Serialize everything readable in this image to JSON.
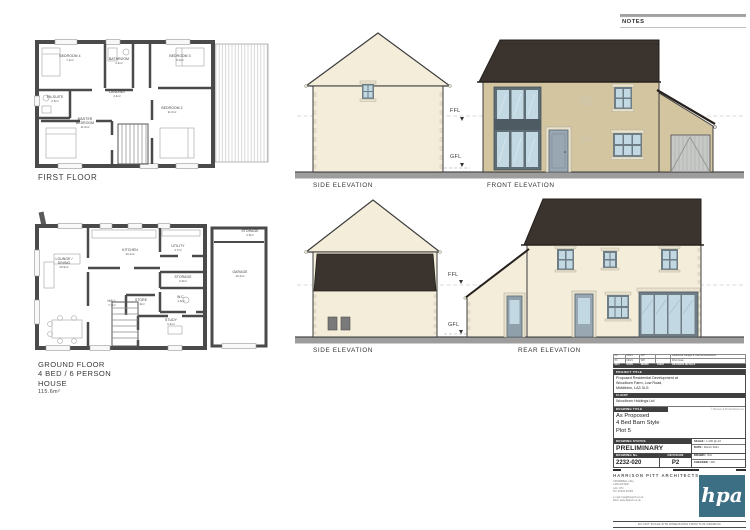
{
  "notes_panel": {
    "title": "NOTES"
  },
  "floor_plans": {
    "first_floor": {
      "title": "FIRST FLOOR",
      "rooms": [
        {
          "name": "BEDROOM 4",
          "area": "7.1m²"
        },
        {
          "name": "BATHROOM",
          "area": "4.4m²"
        },
        {
          "name": "BEDROOM 3",
          "area": "9.0m²"
        },
        {
          "name": "EN-SUITE",
          "area": "2.6m²"
        },
        {
          "name": "LANDING",
          "area": "4.4m²"
        },
        {
          "name": "MASTER BEDROOM",
          "area": "11.9m²"
        },
        {
          "name": "BEDROOM 2",
          "area": "11.0m²"
        }
      ]
    },
    "ground_floor": {
      "title": "GROUND FLOOR",
      "subtitle1": "4 BED / 6 PERSON",
      "subtitle2": "HOUSE",
      "area": "115.6m²",
      "rooms": [
        {
          "name": "LOUNGE / DINING",
          "area": "20.9m²"
        },
        {
          "name": "KITCHEN",
          "area": "10.4m²"
        },
        {
          "name": "UTILITY",
          "area": "4.7m²"
        },
        {
          "name": "STORAGE",
          "area": "0.9m²"
        },
        {
          "name": "HALL",
          "area": "7.4m²"
        },
        {
          "name": "STORE",
          "area": "1.9m²"
        },
        {
          "name": "W.C.",
          "area": "1.5m²"
        },
        {
          "name": "STUDY",
          "area": "6.4m²"
        },
        {
          "name": "GARAGE",
          "area": "16.4m²"
        },
        {
          "name": "STORAGE",
          "area": "2.8m²"
        }
      ]
    }
  },
  "elevations": {
    "top_side_label": "SIDE ELEVATION",
    "front_label": "FRONT ELEVATION",
    "mid_side_label": "SIDE ELEVATION",
    "rear_label": "REAR ELEVATION",
    "ffl": "FFL",
    "gfl": "GFL"
  },
  "title_block": {
    "revision_table": {
      "headers": [
        "REV",
        "DATE",
        "DRWN",
        "CHKD",
        "REVISION DETAILS"
      ],
      "rows": [
        {
          "rev": "P2",
          "date": "03/21",
          "drwn": "WH",
          "chkd": "-",
          "details": "Additional Garage & Internal Alterations"
        },
        {
          "rev": "P1",
          "date": "02/21",
          "drwn": "WH",
          "chkd": "-",
          "details": "First Issue"
        }
      ]
    },
    "project_title_label": "PROJECT TITLE",
    "project_title_lines": [
      "Proposed Residential Development at",
      "Woodburn Farm, Low Road,",
      "Middleton, LA3 3LG"
    ],
    "client_label": "CLIENT",
    "client": "Woodburn Holdings Ltd",
    "drawing_title_label": "DRAWING TITLE",
    "copyright": "© Harrison & Pitt Architects Ltd",
    "drawing_title_lines": [
      "As Proposed",
      "4 Bed Barn Style",
      "Plot 5"
    ],
    "drawing_status_label": "DRAWING STATUS",
    "drawing_status": "PRELIMINARY",
    "scale_label": "SCALE :",
    "scale": "1:100 @ A3",
    "date_label": "DATE :",
    "date": "March 2021",
    "drawing_no_label": "DRAWING No.",
    "drawing_no": "2232-020",
    "revision_label": "REVISION",
    "revision": "P2",
    "drawn_label": "DRAWN :",
    "drawn": "WH",
    "checked_label": "CHECKED :",
    "checked": "SW",
    "practice_name": "HARRISON PITT ARCHITECTS",
    "address_lines": [
      "CROMWELL HILL",
      "LANCASTER",
      "LA1 1YN",
      "Tel: 01524 63784"
    ],
    "email": "e-mail: hpa@hparch.co.uk",
    "web": "Web: www.hparch.co.uk",
    "logo_text": "hpa",
    "disclaimer": "DO NOT SCALE SITE DIMENSIONS FROM THIS DRAWING"
  },
  "colors": {
    "cream_wall": "#f4edda",
    "tan_wall": "#d2c5a0",
    "roof_dark": "#3a332e",
    "glass": "#c2d8e2",
    "frame": "#6f7d85",
    "ground_bar": "#9d9d9d",
    "logo_teal": "#3c6e84"
  }
}
